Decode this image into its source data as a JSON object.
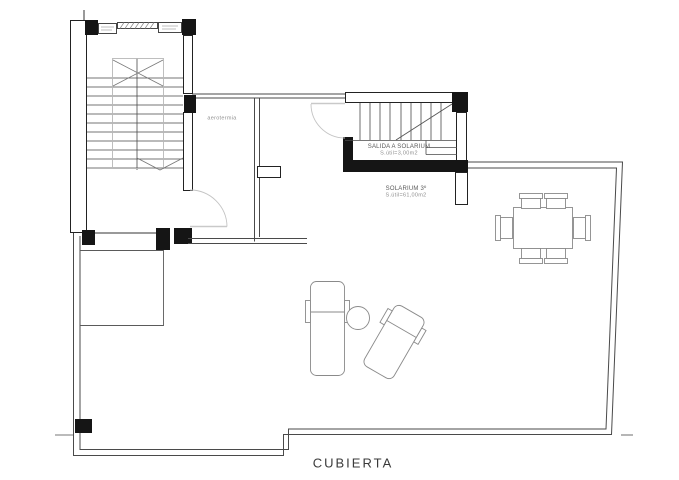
{
  "plan": {
    "title": "CUBIERTA",
    "rooms": {
      "aerotermia": {
        "label": "aerotermia"
      },
      "salida": {
        "label": "SALIDA A SOLARIUM",
        "area": "S.útil=3,00m2"
      },
      "solarium": {
        "label": "SOLARIUM 3º",
        "area": "S.útil=61,00m2"
      }
    },
    "colors": {
      "wall": "#151515",
      "line": "#3c3c3c",
      "light_line": "#b8b8b8",
      "furniture": "#8a8a8a",
      "text": "#5a5a5a"
    }
  }
}
